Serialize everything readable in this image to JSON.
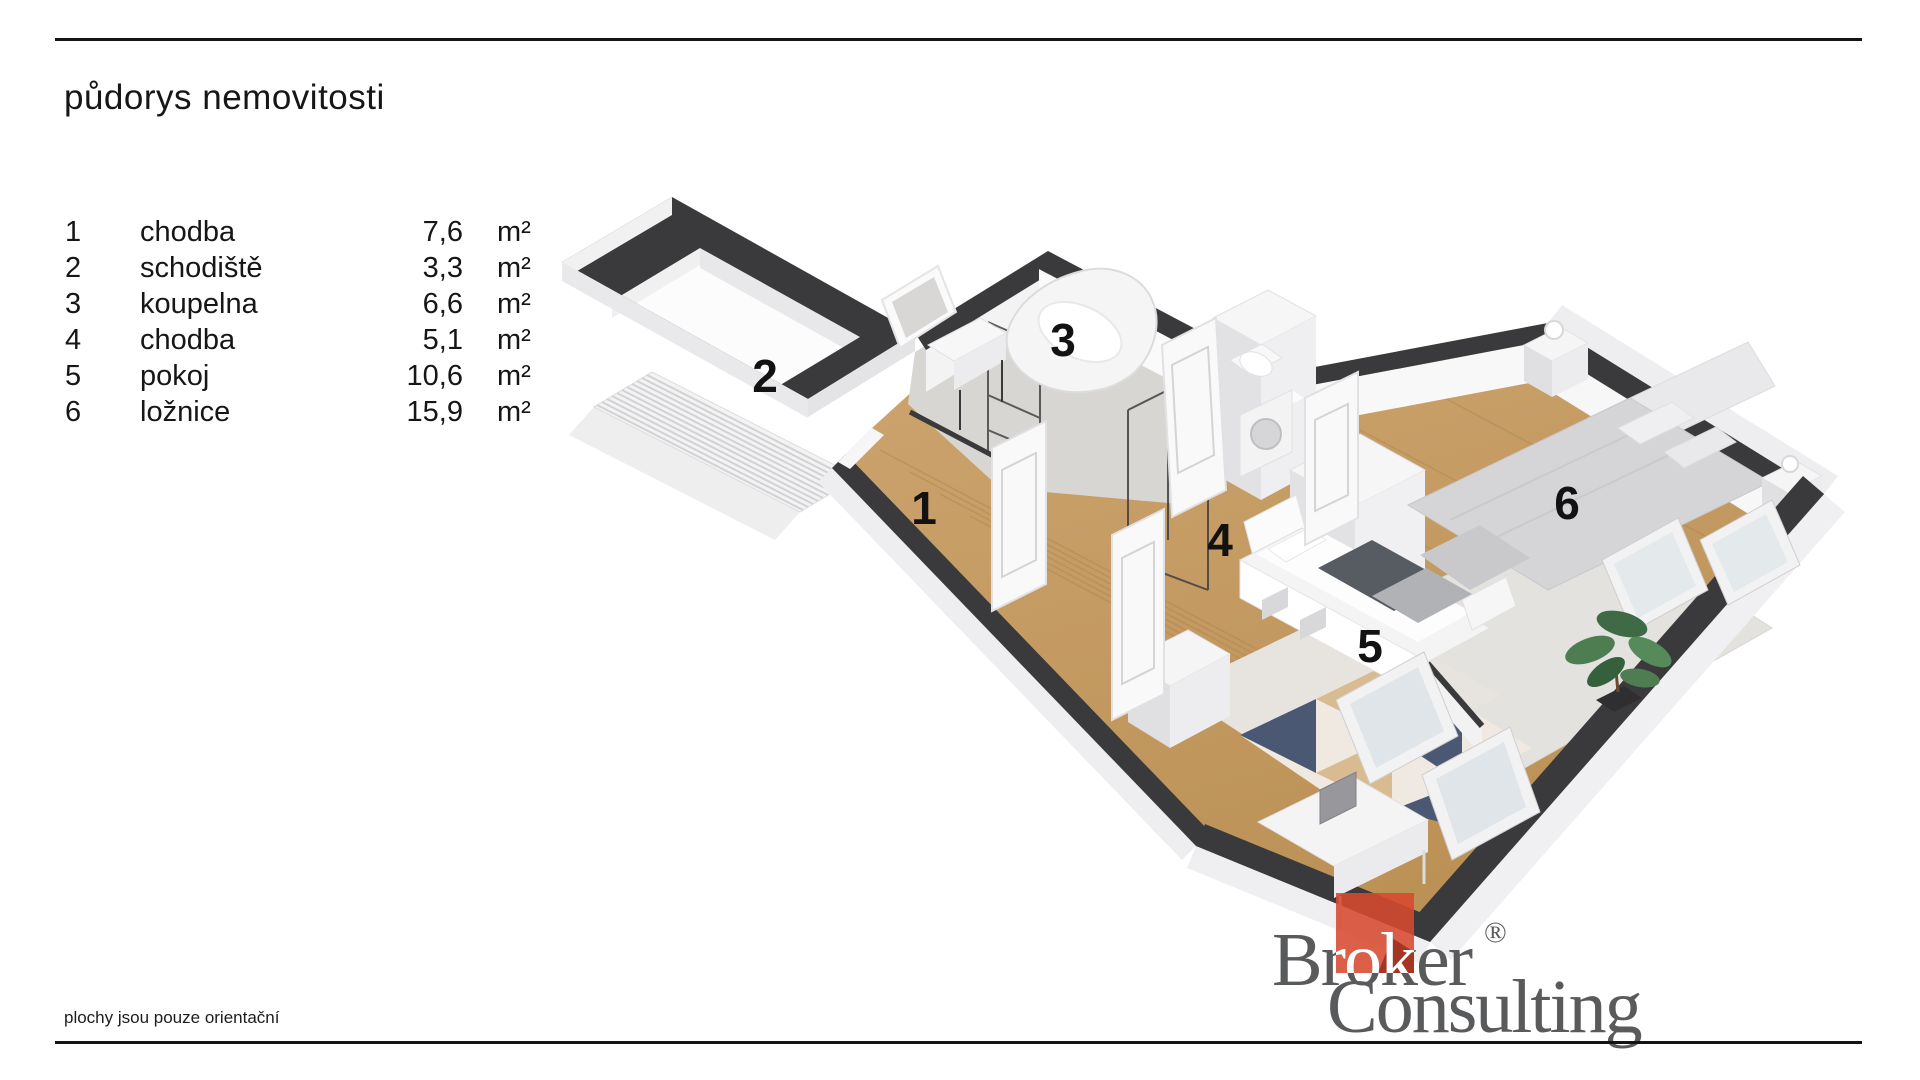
{
  "header": {
    "title": "půdorys nemovitosti"
  },
  "legend": {
    "rows": [
      {
        "num": "1",
        "name": "chodba",
        "area": "7,6",
        "unit": "m²"
      },
      {
        "num": "2",
        "name": "schodiště",
        "area": "3,3",
        "unit": "m²"
      },
      {
        "num": "3",
        "name": "koupelna",
        "area": "6,6",
        "unit": "m²"
      },
      {
        "num": "4",
        "name": "chodba",
        "area": "5,1",
        "unit": "m²"
      },
      {
        "num": "5",
        "name": "pokoj",
        "area": "10,6",
        "unit": "m²"
      },
      {
        "num": "6",
        "name": "ložnice",
        "area": "15,9",
        "unit": "m²"
      }
    ]
  },
  "plan": {
    "labels": [
      "1",
      "2",
      "3",
      "4",
      "5",
      "6"
    ]
  },
  "footer": {
    "note": "plochy jsou pouze orientační"
  },
  "logo": {
    "word1": "Broker",
    "word2": "Consulting",
    "registered": "®",
    "accent_color": "#d7492f",
    "text_color": "#595a5c"
  },
  "colors": {
    "wall_dark": "#3a3a3c",
    "floor_wood": "#c79e65",
    "tile": "#d8d6d3",
    "rule": "#141414"
  }
}
